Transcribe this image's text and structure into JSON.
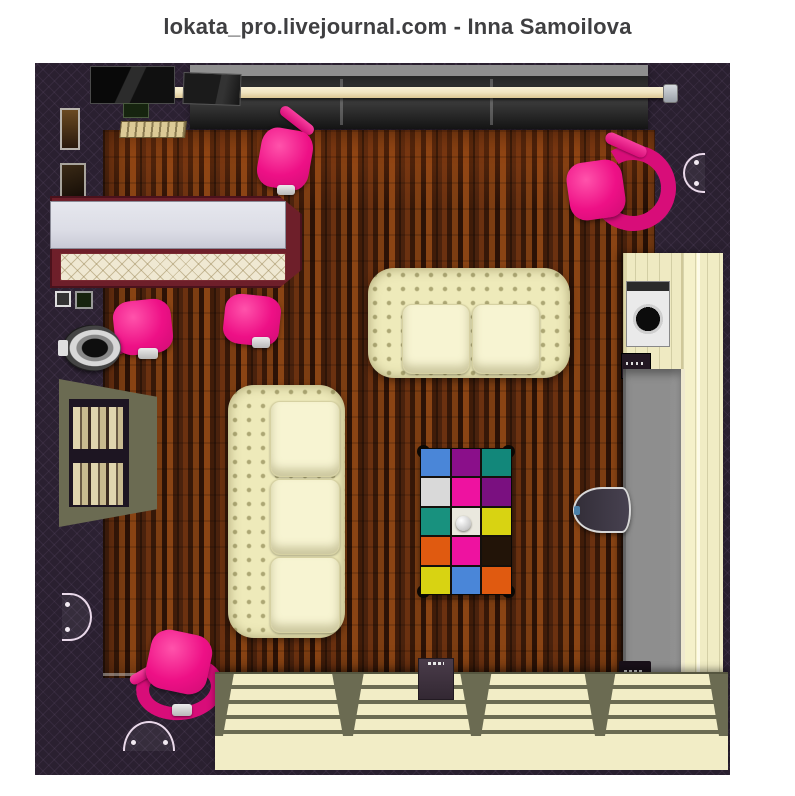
{
  "page": {
    "title": "lokata_pro.livejournal.com - Inna Samoilova",
    "width_px": 795,
    "height_px": 796
  },
  "scene": {
    "description": "Top-down 3D interior design render of a lounge room with dark purple quilted walls and dark wood plank floor",
    "colors": {
      "background": "#ffffff",
      "title_text": "#3f3f41",
      "wall": "#2a2030",
      "floor_dark": "#30150a",
      "floor_mid": "#6b3110",
      "floor_light": "#8a4414",
      "pink": "#ee1086",
      "pink_dark": "#d80d79",
      "cream": "#eeeaba",
      "cushion": "#f7f4d2",
      "bar_top": "#dcdde6",
      "bar_border": "#6e1f2a",
      "bar_panel": "#efe8d2",
      "cabinet": "#efeac2",
      "desk_gray": "#8e8e8e",
      "shelf_divider": "#6b6b52",
      "shelf_cream": "#f2edc6",
      "rod": "#f0e4c0",
      "window": "#1e1e1e",
      "sconce": "#ead9ea"
    },
    "rug": {
      "rows": 5,
      "cols": 3,
      "colors": [
        [
          "#4a86d8",
          "#8a0f8a",
          "#12877a"
        ],
        [
          "#d9d9d9",
          "#ee12a0",
          "#7a1080"
        ],
        [
          "#18917e",
          "#eae8de",
          "#d8d312"
        ],
        [
          "#e05a10",
          "#ee12a0",
          "#221408"
        ],
        [
          "#d8d312",
          "#4a86d8",
          "#e05a10"
        ]
      ]
    },
    "furniture": [
      "bar counter with white top and quilted cream front",
      "pink swivel chair x5",
      "cream chesterfield loveseat (2 seats)",
      "cream chesterfield sofa (3 seats)",
      "patchwork coffee table with white decor ball",
      "right-wall cabinet with washing machine and hi-fi unit",
      "gray-top desk with tucked oval chair",
      "low stepped shelving unit along bottom wall",
      "floor speaker box",
      "curtain rod with dark pleated drapes",
      "wall sconce x3",
      "left wall niche shelf with books",
      "picture frames",
      "round wall lamp"
    ]
  }
}
